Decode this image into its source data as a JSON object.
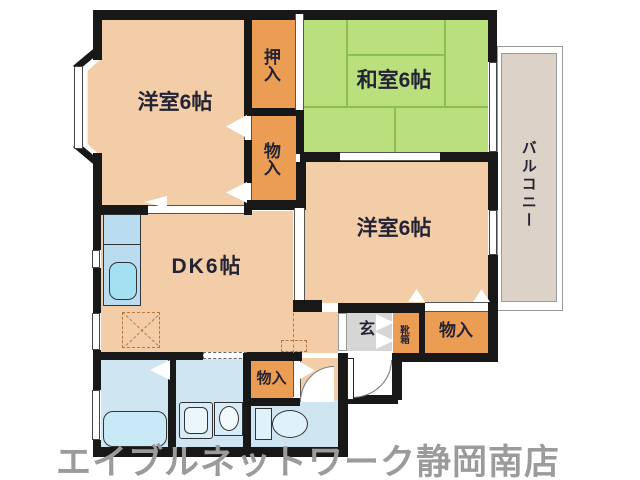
{
  "floorplan": {
    "rooms": {
      "western_room_left": {
        "label": "洋室6帖"
      },
      "japanese_room": {
        "label": "和室6帖"
      },
      "western_room_right": {
        "label": "洋室6帖"
      },
      "dining_kitchen": {
        "label": "DK6帖"
      },
      "closet_oshiire": {
        "label": "押入"
      },
      "closet_middle": {
        "label": "物入"
      },
      "closet_entrance": {
        "label": "物入"
      },
      "closet_bottom": {
        "label": "物入"
      },
      "entrance": {
        "label": "玄"
      },
      "shoe_box": {
        "label": "靴箱"
      },
      "balcony": {
        "label": "バルコニー"
      }
    },
    "watermark": "エイブルネットワーク静岡南店",
    "colors": {
      "wall": "#181818",
      "room_peach": "#f2cda7",
      "closet_orange": "#eb9d54",
      "tatami_green": "#b9e07d",
      "tatami_line": "#8cbf52",
      "sanitary_blue": "#cfe6f2",
      "fixture_blue": "#d6ecf8",
      "entrance_gray": "#d6d6d6",
      "balcony_beige": "#ddd2c8",
      "watermark_gray": "#9b9b9b",
      "label_dark": "#232334"
    }
  }
}
